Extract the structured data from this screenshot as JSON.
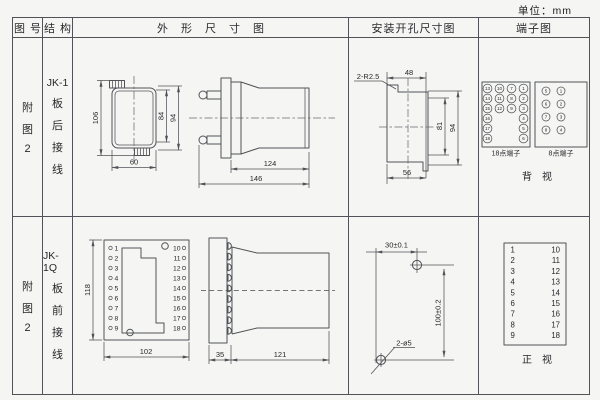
{
  "unit": "单位：mm",
  "header": {
    "c1": "图号",
    "c2": "结构",
    "c3": "外形尺寸图",
    "c4": "安装开孔尺寸图",
    "c5": "端子图"
  },
  "row1": {
    "fig": [
      "附",
      "图",
      "2"
    ],
    "struct": [
      "JK-1",
      "板",
      "后",
      "接",
      "线"
    ],
    "front": {
      "h106": "106",
      "h84": "84",
      "h94": "94",
      "w60": "60"
    },
    "side": {
      "l124": "124",
      "l146": "146"
    },
    "cut": {
      "r": "2-R2.5",
      "w48": "48",
      "h81": "81",
      "h94": "94",
      "w56": "56"
    },
    "t18": {
      "label": "18点端子",
      "rows": [
        [
          "13",
          "10",
          "7",
          "1"
        ],
        [
          "14",
          "11",
          "8",
          "2"
        ],
        [
          "15",
          "12",
          "9",
          "3"
        ],
        [
          "16",
          "4"
        ],
        [
          "17",
          "5"
        ],
        [
          "18",
          "6"
        ]
      ]
    },
    "t8": {
      "label": "8点端子",
      "rows": [
        [
          "5",
          "1"
        ],
        [
          "6",
          "2"
        ],
        [
          "7",
          "3"
        ],
        [
          "8",
          "4"
        ]
      ]
    },
    "view": "背　视"
  },
  "row2": {
    "fig": [
      "附",
      "图",
      "2"
    ],
    "struct": [
      "JK-1Q",
      "板",
      "前",
      "接",
      "线"
    ],
    "front": {
      "h118": "118",
      "w102": "102"
    },
    "side": {
      "w35": "35",
      "l121": "121"
    },
    "holes": {
      "dx": "30±0.1",
      "dy": "100±0.2",
      "label": "2-ø5"
    },
    "terms_left": [
      "1",
      "2",
      "3",
      "4",
      "5",
      "6",
      "7",
      "8",
      "9"
    ],
    "terms_right": [
      "10",
      "11",
      "12",
      "13",
      "14",
      "15",
      "16",
      "17",
      "18"
    ],
    "view": "正　视"
  },
  "colors": {
    "line": "#515257",
    "text": "#28282c",
    "background": "#f5f5f3"
  }
}
